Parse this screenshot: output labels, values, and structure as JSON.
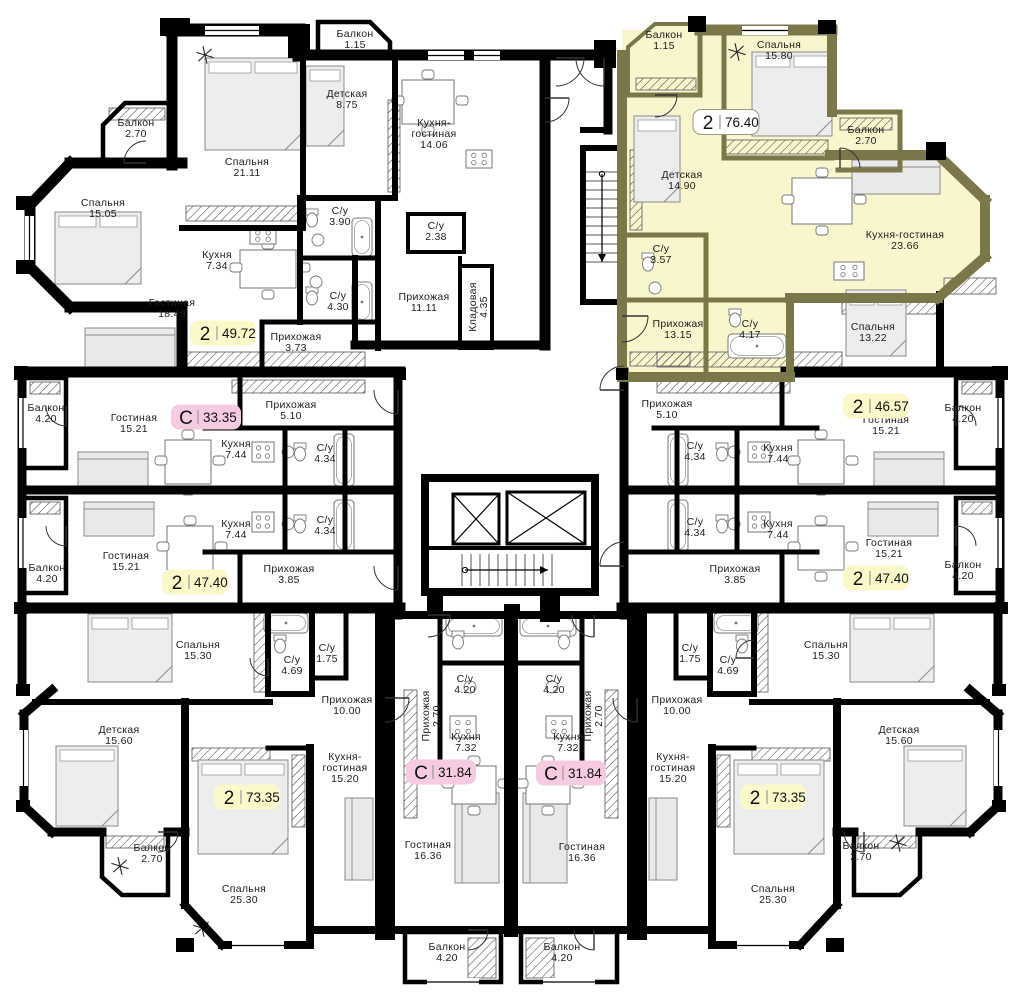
{
  "plan_title": "Типовой этаж — план квартир",
  "colors": {
    "wall": "#000000",
    "highlight_wall": "#7B7748",
    "highlight_fill": "#F9F6CE",
    "badge_yellow": "#FBF8CA",
    "badge_pink": "#F6CBE2",
    "badge_white": "#FFFFFF",
    "label_text": "#1d1d1d"
  },
  "legend": {
    "badge_type_two_rooms": "2",
    "badge_type_studio": "С"
  },
  "rooms": [
    {
      "name": "Балкон",
      "area": "2.70",
      "x": 136,
      "y": 126
    },
    {
      "name": "Спальня",
      "area": "15.05",
      "x": 103,
      "y": 206
    },
    {
      "name": "Спальня",
      "area": "21.11",
      "x": 247,
      "y": 165
    },
    {
      "name": "Детская",
      "area": "8.75",
      "x": 347,
      "y": 97
    },
    {
      "name": "Балкон",
      "area": "1.15",
      "x": 355,
      "y": 37
    },
    {
      "name": "Кухня",
      "area": "7.34",
      "x": 217,
      "y": 258
    },
    {
      "name": "Гостиная",
      "area": "18.49",
      "x": 172,
      "y": 306
    },
    {
      "name": "С/у",
      "area": "3.90",
      "x": 340,
      "y": 214
    },
    {
      "name": "С/у",
      "area": "4.30",
      "x": 338,
      "y": 299
    },
    {
      "name": "Прихожая",
      "area": "3.73",
      "x": 296,
      "y": 340
    },
    {
      "name": "Кухня-\nгостиная",
      "area": "14.06",
      "x": 434,
      "y": 126
    },
    {
      "name": "С/у",
      "area": "2.38",
      "x": 436,
      "y": 229
    },
    {
      "name": "Прихожая",
      "area": "11.11",
      "x": 424,
      "y": 300
    },
    {
      "name": "Кладовая",
      "area": "4.35",
      "x": 476,
      "y": 307,
      "rot": -90
    },
    {
      "name": "Балкон",
      "area": "1.15",
      "x": 664,
      "y": 38
    },
    {
      "name": "Спальня",
      "area": "15.80",
      "x": 779,
      "y": 48
    },
    {
      "name": "Балкон",
      "area": "2.70",
      "x": 866,
      "y": 133
    },
    {
      "name": "Детская",
      "area": "14.90",
      "x": 682,
      "y": 178
    },
    {
      "name": "Кухня-гостиная",
      "area": "23.66",
      "x": 905,
      "y": 238
    },
    {
      "name": "С/у",
      "area": "3.57",
      "x": 661,
      "y": 252
    },
    {
      "name": "Прихожая",
      "area": "13.15",
      "x": 678,
      "y": 327
    },
    {
      "name": "С/у",
      "area": "4.17",
      "x": 750,
      "y": 327
    },
    {
      "name": "Спальня",
      "area": "13.22",
      "x": 873,
      "y": 330
    },
    {
      "name": "Прихожая",
      "area": "5.10",
      "x": 667,
      "y": 407
    },
    {
      "name": "Гостиная",
      "area": "15.21",
      "x": 886,
      "y": 423
    },
    {
      "name": "Балкон",
      "area": "4.20",
      "x": 963,
      "y": 411
    },
    {
      "name": "С/у",
      "area": "4.34",
      "x": 695,
      "y": 449
    },
    {
      "name": "Кухня",
      "area": "7.44",
      "x": 778,
      "y": 451
    },
    {
      "name": "С/у",
      "area": "4.34",
      "x": 695,
      "y": 525
    },
    {
      "name": "Кухня",
      "area": "7.44",
      "x": 778,
      "y": 527
    },
    {
      "name": "Гостиная",
      "area": "15.21",
      "x": 889,
      "y": 546
    },
    {
      "name": "Прихожая",
      "area": "3.85",
      "x": 735,
      "y": 572
    },
    {
      "name": "Балкон",
      "area": "4.20",
      "x": 963,
      "y": 568
    },
    {
      "name": "Балкон",
      "area": "4.20",
      "x": 46,
      "y": 411
    },
    {
      "name": "Гостиная",
      "area": "15.21",
      "x": 134,
      "y": 421
    },
    {
      "name": "Прихожая",
      "area": "5.10",
      "x": 291,
      "y": 408
    },
    {
      "name": "Кухня",
      "area": "7.44",
      "x": 236,
      "y": 447
    },
    {
      "name": "С/у",
      "area": "4.34",
      "x": 325,
      "y": 451
    },
    {
      "name": "Кухня",
      "area": "7.44",
      "x": 236,
      "y": 527
    },
    {
      "name": "С/у",
      "area": "4.34",
      "x": 325,
      "y": 523
    },
    {
      "name": "Гостиная",
      "area": "15.21",
      "x": 126,
      "y": 559
    },
    {
      "name": "Балкон",
      "area": "4.20",
      "x": 47,
      "y": 571
    },
    {
      "name": "Прихожая",
      "area": "3.85",
      "x": 289,
      "y": 572
    },
    {
      "name": "Спальня",
      "area": "15.30",
      "x": 198,
      "y": 648
    },
    {
      "name": "С/у",
      "area": "4.69",
      "x": 292,
      "y": 663
    },
    {
      "name": "С/у",
      "area": "1.75",
      "x": 327,
      "y": 651
    },
    {
      "name": "Прихожая",
      "area": "10.00",
      "x": 347,
      "y": 703
    },
    {
      "name": "Детская",
      "area": "15.60",
      "x": 119,
      "y": 733
    },
    {
      "name": "Балкон",
      "area": "2.70",
      "x": 152,
      "y": 851
    },
    {
      "name": "Кухня-\nгостиная",
      "area": "15.20",
      "x": 345,
      "y": 760
    },
    {
      "name": "Спальня",
      "area": "25.30",
      "x": 244,
      "y": 892
    },
    {
      "name": "С/у",
      "area": "4.20",
      "x": 465,
      "y": 682
    },
    {
      "name": "Прихожая",
      "area": "2.70",
      "x": 429,
      "y": 716,
      "rot": -90
    },
    {
      "name": "Кухня",
      "area": "7.32",
      "x": 466,
      "y": 740
    },
    {
      "name": "Гостиная",
      "area": "16.36",
      "x": 428,
      "y": 848
    },
    {
      "name": "Балкон",
      "area": "4.20",
      "x": 447,
      "y": 950
    },
    {
      "name": "С/у",
      "area": "4.20",
      "x": 554,
      "y": 682
    },
    {
      "name": "Прихожая",
      "area": "2.70",
      "x": 591,
      "y": 716,
      "rot": -90
    },
    {
      "name": "Кухня",
      "area": "7.32",
      "x": 568,
      "y": 740
    },
    {
      "name": "Гостиная",
      "area": "16.36",
      "x": 582,
      "y": 850
    },
    {
      "name": "Балкон",
      "area": "4.20",
      "x": 562,
      "y": 950
    },
    {
      "name": "С/у",
      "area": "1.75",
      "x": 690,
      "y": 651
    },
    {
      "name": "С/у",
      "area": "4.69",
      "x": 728,
      "y": 663
    },
    {
      "name": "Спальня",
      "area": "15.30",
      "x": 826,
      "y": 648
    },
    {
      "name": "Прихожая",
      "area": "10.00",
      "x": 677,
      "y": 703
    },
    {
      "name": "Детская",
      "area": "15.60",
      "x": 899,
      "y": 733
    },
    {
      "name": "Кухня-\nгостиная",
      "area": "15.20",
      "x": 673,
      "y": 760
    },
    {
      "name": "Спальня",
      "area": "25.30",
      "x": 773,
      "y": 892
    },
    {
      "name": "Балкон",
      "area": "2.70",
      "x": 861,
      "y": 849
    }
  ],
  "badges": [
    {
      "type": "2",
      "area": "49.72",
      "style": "yellow",
      "x": 223,
      "y": 333
    },
    {
      "type": "С",
      "area": "33.35",
      "style": "pink",
      "x": 206,
      "y": 417
    },
    {
      "type": "2",
      "area": "47.40",
      "style": "yellow",
      "x": 195,
      "y": 582
    },
    {
      "type": "2",
      "area": "76.40",
      "style": "white",
      "x": 726,
      "y": 122
    },
    {
      "type": "2",
      "area": "46.57",
      "style": "yellow",
      "x": 876,
      "y": 406
    },
    {
      "type": "2",
      "area": "47.40",
      "style": "yellow",
      "x": 876,
      "y": 578
    },
    {
      "type": "2",
      "area": "73.35",
      "style": "yellow",
      "x": 247,
      "y": 797
    },
    {
      "type": "С",
      "area": "31.84",
      "style": "pink",
      "x": 441,
      "y": 772
    },
    {
      "type": "С",
      "area": "31.84",
      "style": "pink",
      "x": 571,
      "y": 773
    },
    {
      "type": "2",
      "area": "73.35",
      "style": "yellow",
      "x": 773,
      "y": 797
    }
  ]
}
